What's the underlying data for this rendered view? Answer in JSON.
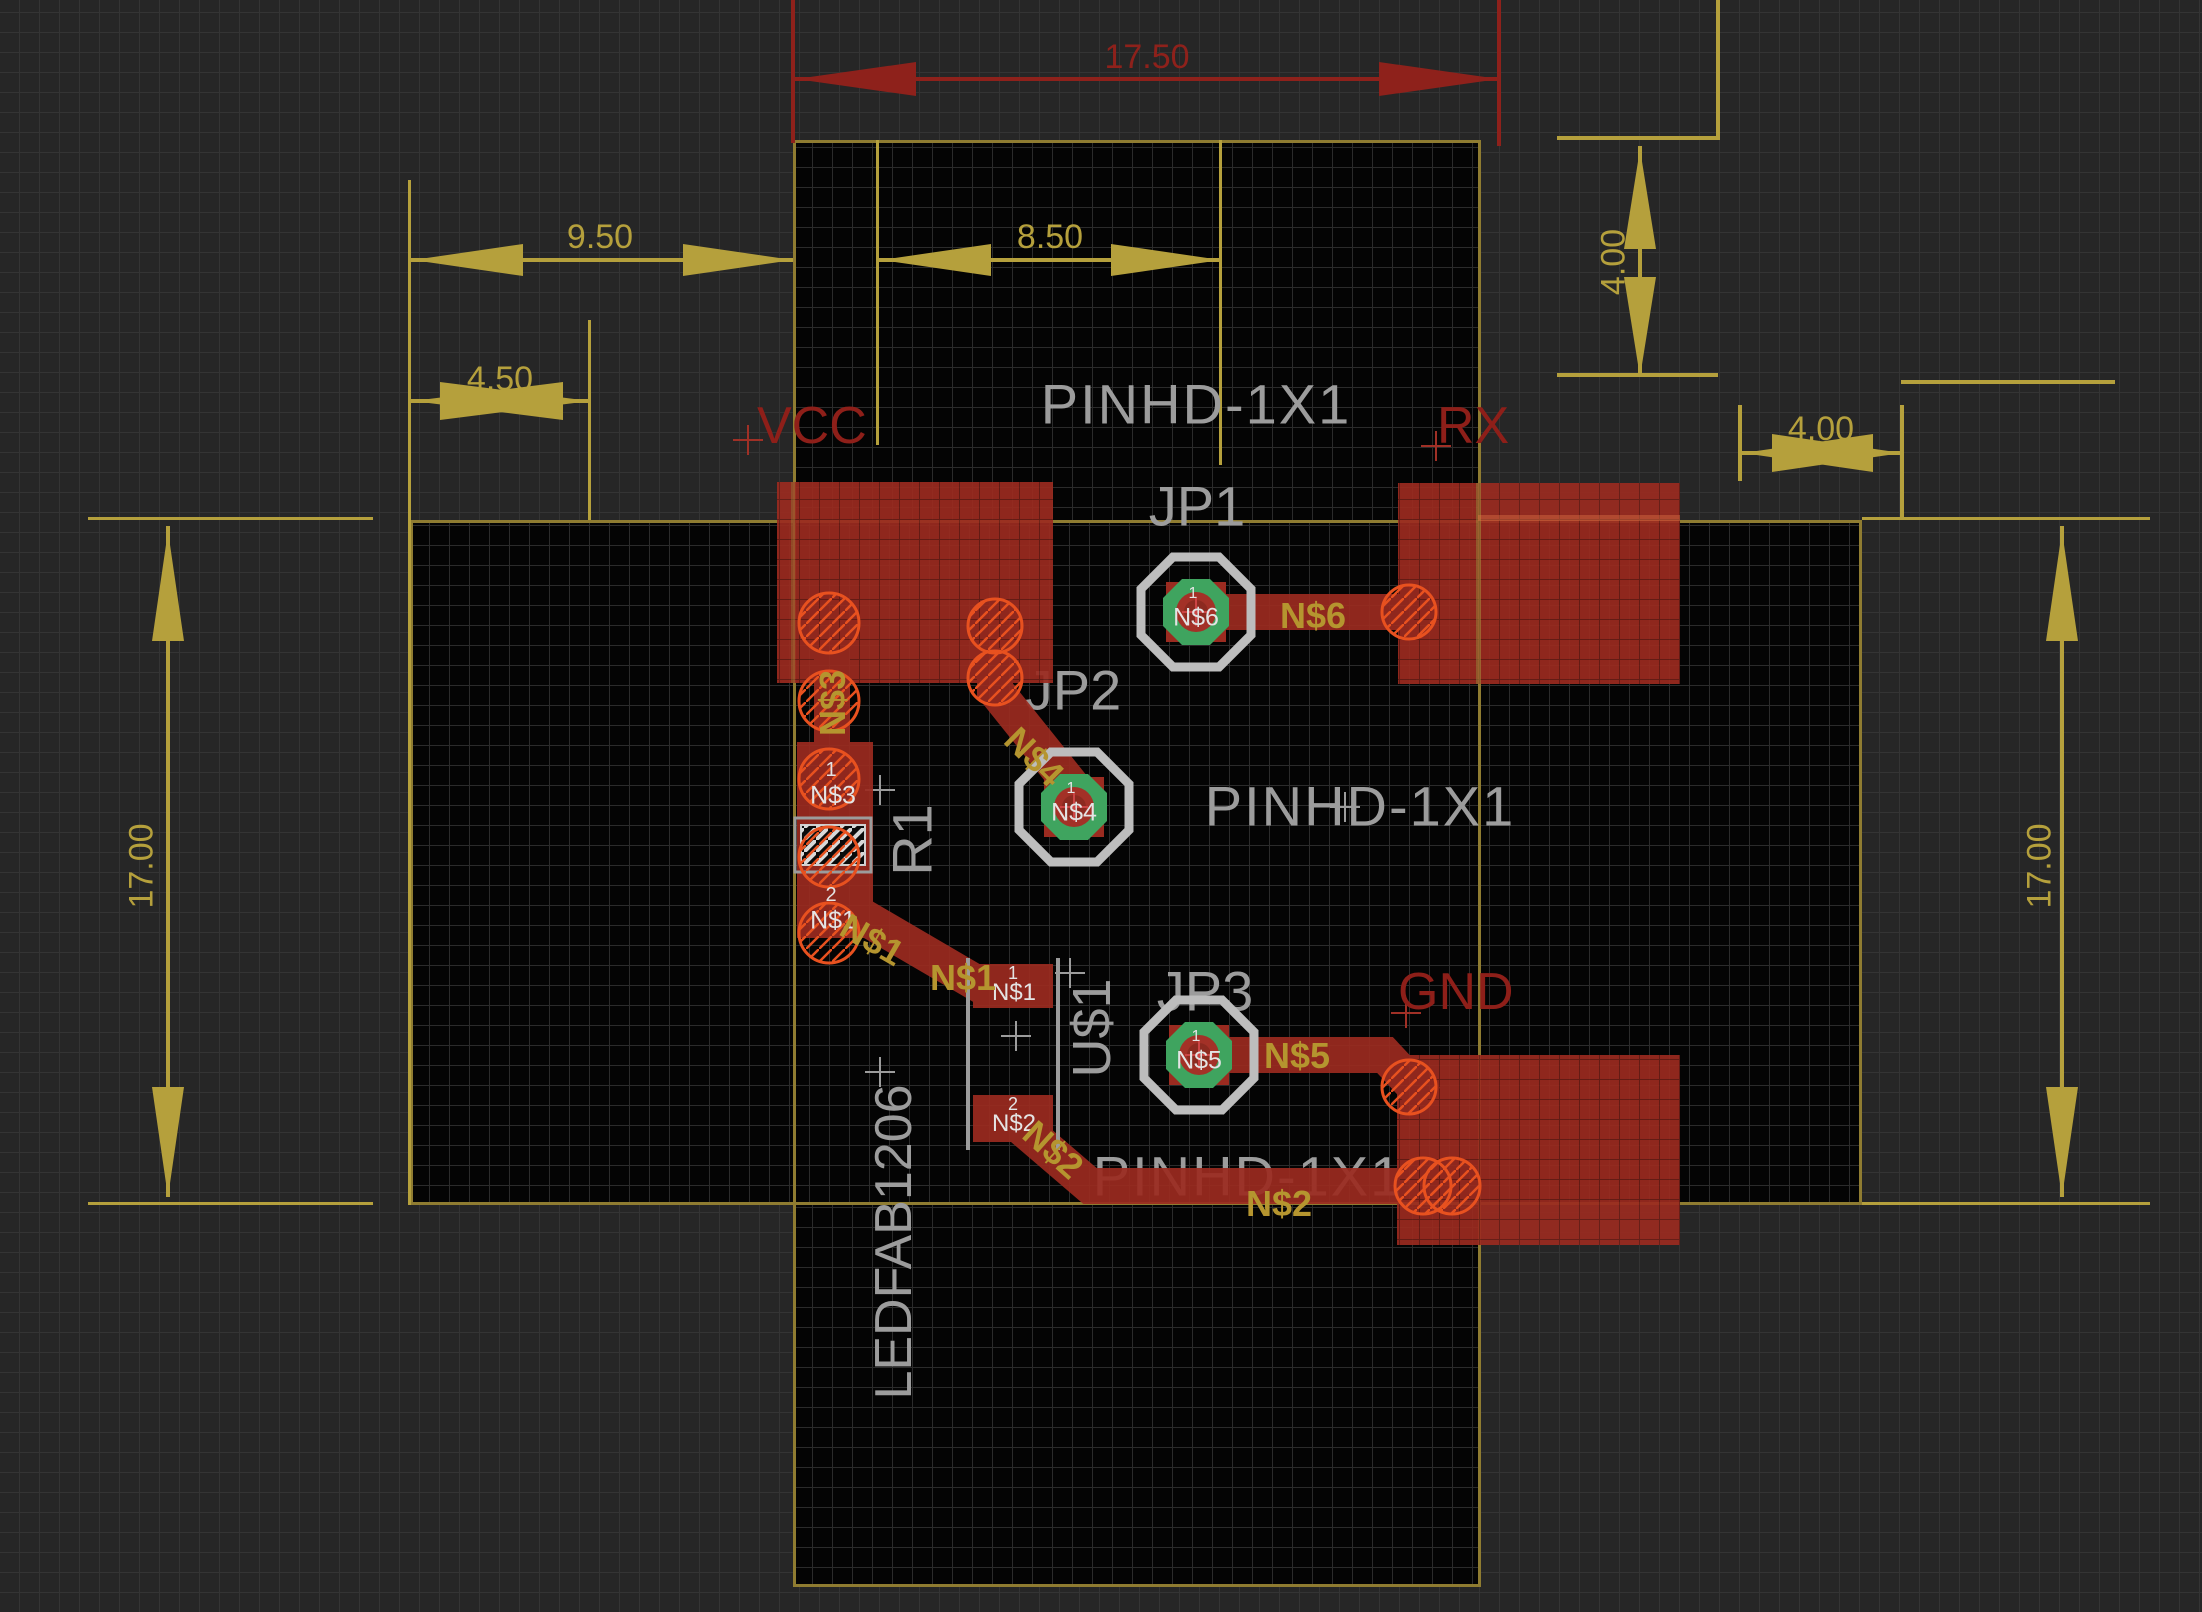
{
  "editor": {
    "type": "pcb-board-layout",
    "colors": {
      "background": "#262626",
      "board": "#040404",
      "board_outline": "#8f7c31",
      "copper": "#9b2b20",
      "dimension_yellow": "#b5a03c",
      "dimension_red": "#8e211b",
      "silkscreen": "#9c9c9c",
      "drill_hatch_orange": "#e8511f",
      "pad_green": "#3fa45f",
      "net_label_yellow": "#b5952f",
      "signal_red": "#8e1f19",
      "pad_text_white": "#e4e4e4"
    }
  },
  "dims": {
    "top_red": "17.50",
    "h950": "9.50",
    "h850": "8.50",
    "h450": "4.50",
    "v400_right": "4.00",
    "h400_right": "4.00",
    "v1700_left": "17.00",
    "v1700_right": "17.00"
  },
  "signals": {
    "vcc": "VCC",
    "rx": "RX",
    "gnd": "GND"
  },
  "packages": {
    "pinhd": "PINHD-1X1"
  },
  "components": {
    "jp1": "JP1",
    "jp2": "JP2",
    "jp3": "JP3",
    "r1": "R1",
    "u1": "U$1",
    "led": "LEDFAB1206"
  },
  "nets": {
    "n1": "N$1",
    "n2": "N$2",
    "n3": "N$3",
    "n4": "N$4",
    "n5": "N$5",
    "n6": "N$6"
  },
  "pins": {
    "p1": "1",
    "p2": "2"
  }
}
